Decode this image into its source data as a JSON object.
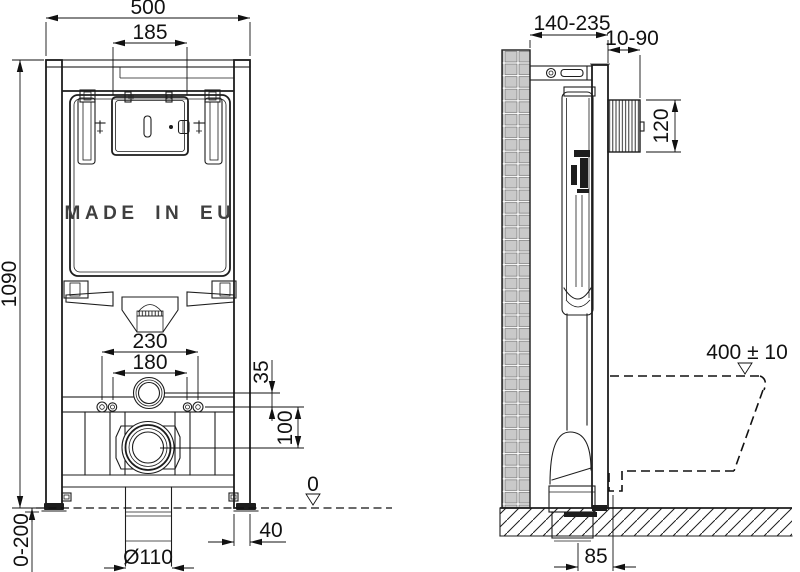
{
  "drawing": {
    "type": "technical installation drawing",
    "subject": "concealed WC cistern frame - front and side view",
    "colors": {
      "line": "#1d1d1d",
      "tile_fill": "#c9c9c9",
      "background": "#ffffff"
    }
  },
  "front_view": {
    "label": "MADE IN EU",
    "dims": {
      "total_width": "500",
      "plate_width": "185",
      "total_height": "1090",
      "fixing_outer": "230",
      "fixing_inner": "180",
      "supply_offset": "35",
      "outlet_drop": "100",
      "leg_adjust": "0-200",
      "foot_depth": "40",
      "outlet_dia": "Ø110",
      "floor_datum": "0"
    }
  },
  "side_view": {
    "dims": {
      "depth_adjust": "140-235",
      "plate_recess": "10-90",
      "plate_height": "120",
      "bowl_height": "400 ± 10",
      "outlet_offset": "85"
    }
  }
}
